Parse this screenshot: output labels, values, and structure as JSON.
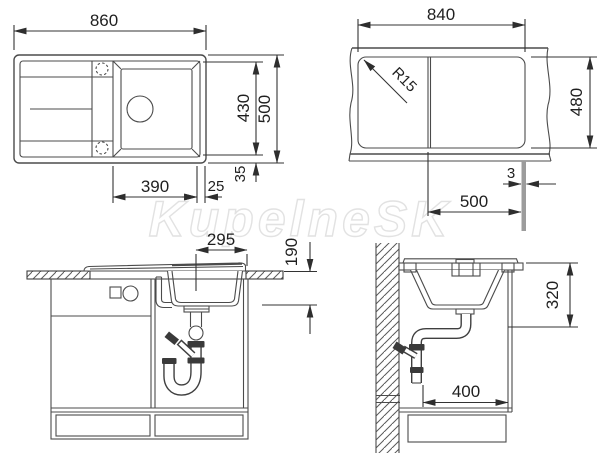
{
  "watermark": {
    "text": "KupelneSK"
  },
  "top_view": {
    "overall_width": "860",
    "overall_depth": "500",
    "inner_depth": "430",
    "bowl_width": "390",
    "bowl_edge_gap": "25",
    "rim_margin": "35"
  },
  "cutout_view": {
    "cutout_width": "840",
    "cutout_depth": "480",
    "corner_radius": "R15",
    "bowl_section_width": "500",
    "partition_width": "3"
  },
  "front_view": {
    "drain_offset": "295",
    "bowl_depth": "190"
  },
  "side_view": {
    "under_counter_depth": "320",
    "wall_clearance": "400"
  }
}
